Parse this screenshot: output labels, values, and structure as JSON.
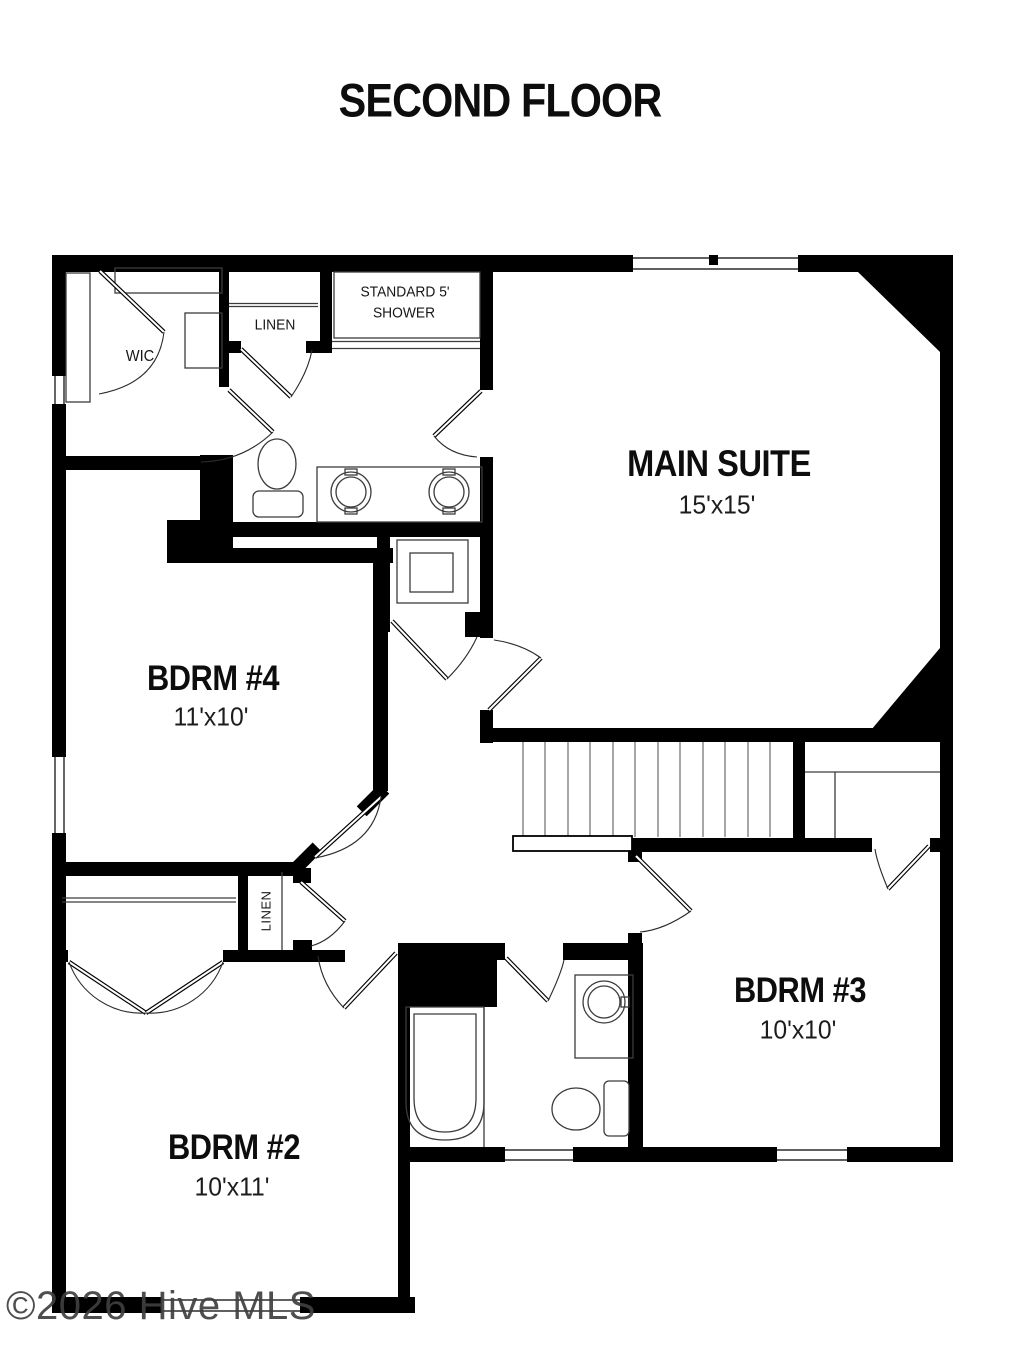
{
  "title": "SECOND FLOOR",
  "watermark": "©2026 Hive MLS",
  "colors": {
    "wall": "#000000",
    "background": "#ffffff",
    "fixture_line": "#3c3c3c",
    "stair_line": "#8f8f8f",
    "watermark": "#3f3f3f"
  },
  "rooms": {
    "main_suite": {
      "name": "MAIN SUITE",
      "dims": "15'x15'"
    },
    "bdrm4": {
      "name": "BDRM #4",
      "dims": "11'x10'"
    },
    "bdrm3": {
      "name": "BDRM #3",
      "dims": "10'x10'"
    },
    "bdrm2": {
      "name": "BDRM #2",
      "dims": "10'x11'"
    },
    "wic": {
      "name": "WIC"
    },
    "linen_upper": {
      "name": "LINEN"
    },
    "linen_lower": {
      "name": "LINEN"
    },
    "shower": {
      "line1": "STANDARD 5'",
      "line2": "SHOWER"
    }
  }
}
